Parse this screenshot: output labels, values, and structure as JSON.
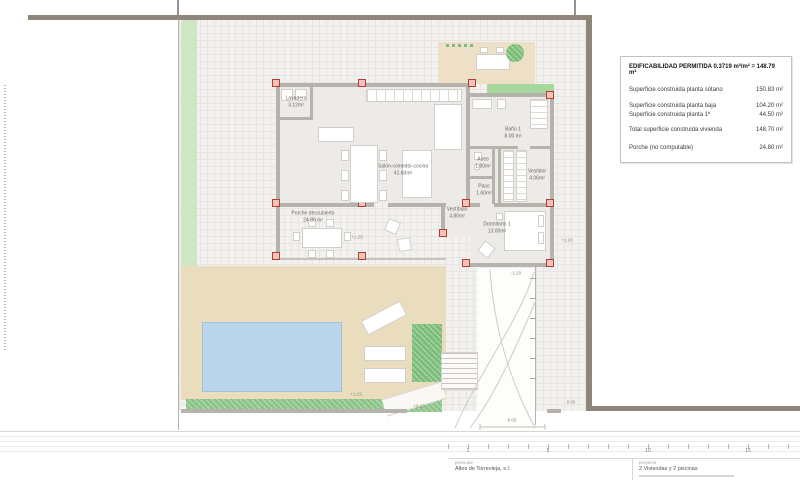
{
  "sheet_type": "architectural-floor-plan",
  "legend": {
    "title": "EDIFICABILIDAD PERMITIDA 0.3719 m²/m² = 148.79 m²",
    "rows": [
      {
        "label": "Superficie construida planta sótano",
        "value": "150.83 m²"
      },
      {
        "label": "Superficie construida planta baja",
        "value": "104.20 m²"
      },
      {
        "label": "Superficie construida planta 1ª",
        "value": "44.50 m²"
      },
      {
        "label": "Total superficie construida vivienda",
        "value": "148.70 m²"
      },
      {
        "label": "Porche (no computable)",
        "value": "24.80 m²"
      }
    ]
  },
  "rooms": [
    {
      "name": "Lavadero",
      "area": "3.12m²"
    },
    {
      "name": "Salón-comedor-cocina",
      "area": "41.60m²"
    },
    {
      "name": "Baño 1",
      "area": "8.00 m²"
    },
    {
      "name": "Aseo",
      "area": "1.80m²"
    },
    {
      "name": "Vestidor",
      "area": "4.06m²"
    },
    {
      "name": "Paso",
      "area": "1.60m²"
    },
    {
      "name": "Vestíbulo",
      "area": "4.80m²"
    },
    {
      "name": "Dormitorio 1",
      "area": "13.00m²"
    },
    {
      "name": "Porche descubierto",
      "area": "24.80 m²"
    }
  ],
  "markers": [
    "+1.20",
    "+1.20",
    "-1.20",
    "+1.15",
    "+0.15",
    "0.00",
    "6.00"
  ],
  "scalebar": {
    "labels": [
      "1",
      "5",
      "10",
      "15"
    ]
  },
  "titleblock": {
    "promotor_label": "promotor",
    "promotor_name": "Altos de Torrevieja, s.l.",
    "proyecto_label": "proyecto",
    "proyecto_name": "2 Viviendas y 2 piscinas"
  },
  "colors": {
    "site_wall": "#8E857B",
    "interior_wall": "#B6B2AC",
    "pillar_red": "#B53C30",
    "pool_blue": "#BAD4E9",
    "terrace_beige": "#E9DDBD",
    "planter_green": "#CFE5C3",
    "grass_green": "#8FCA8C",
    "paving_gray": "#F2F1EF"
  }
}
